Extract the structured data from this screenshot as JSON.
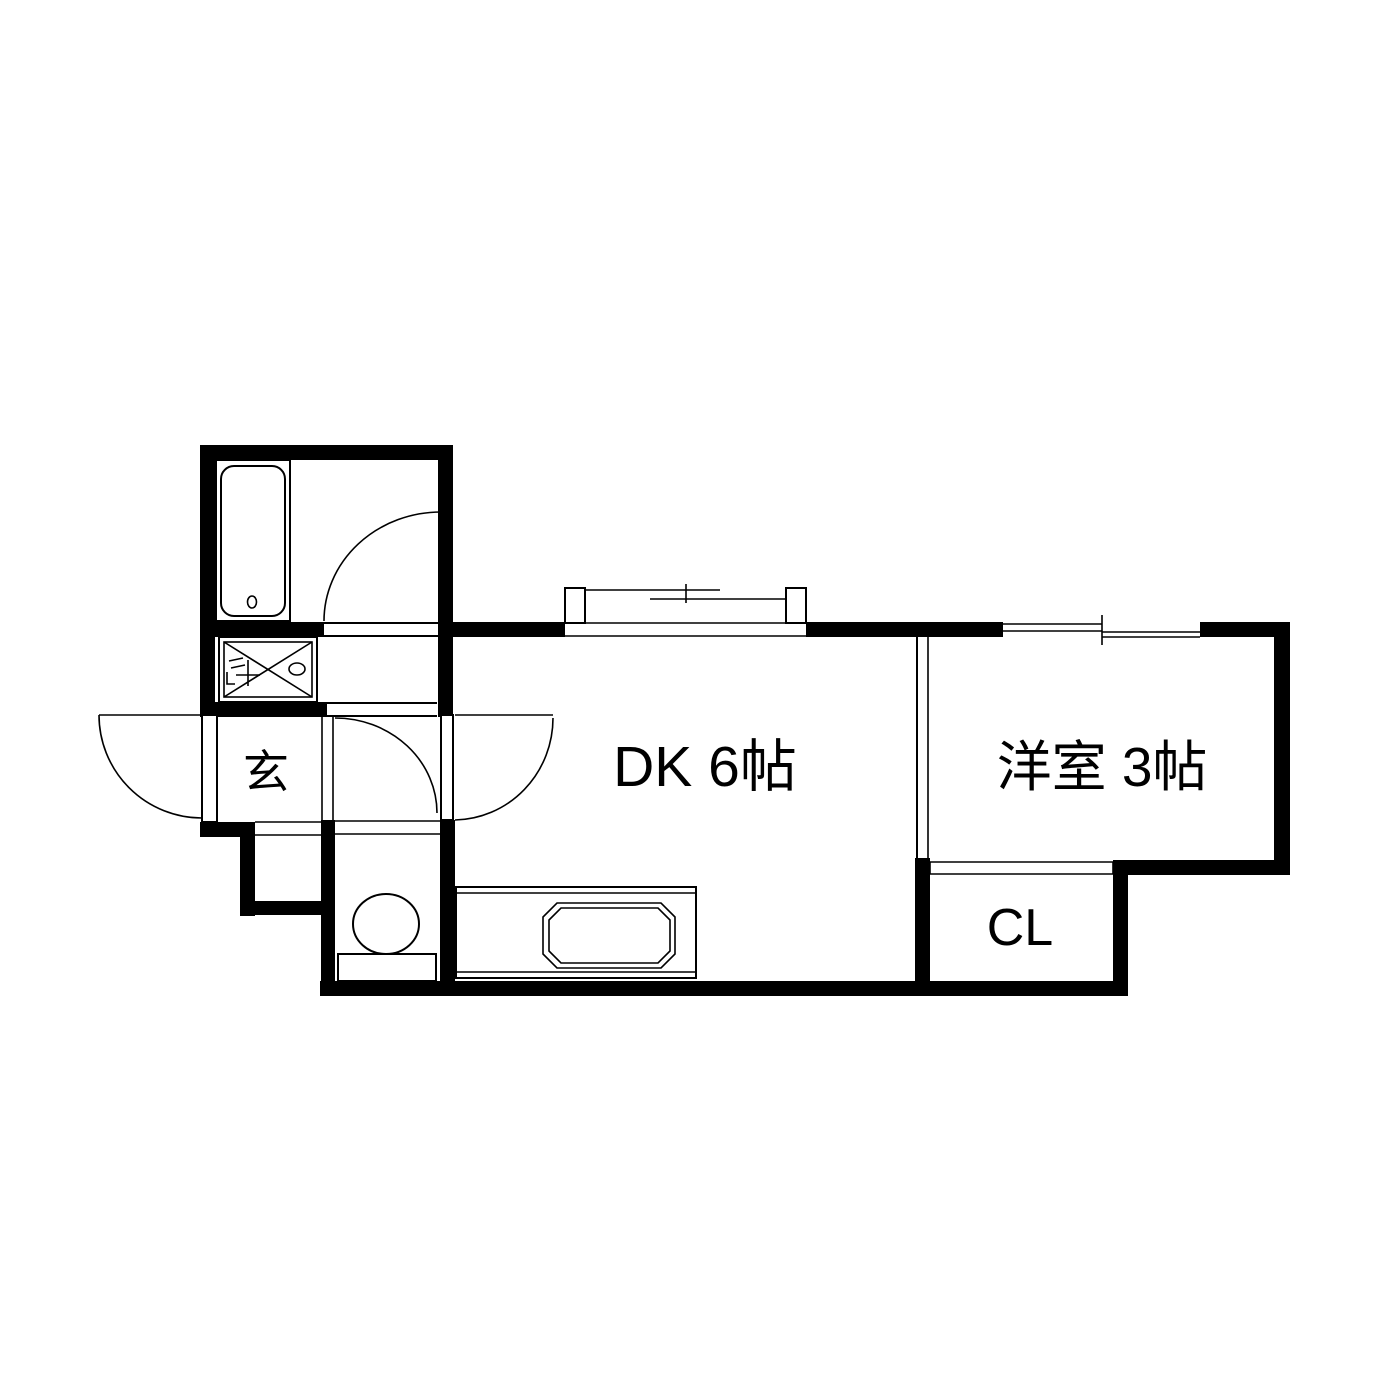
{
  "floor_plan": {
    "background": "#ffffff",
    "wall_color": "#000000",
    "line_color": "#000000",
    "text_color": "#000000",
    "rooms": {
      "entrance": {
        "label": "玄"
      },
      "dining_kitchen": {
        "label": "DK 6帖"
      },
      "western_room": {
        "label": "洋室 3帖"
      },
      "closet": {
        "label": "CL"
      }
    },
    "fixtures": [
      "bathtub-icon",
      "washing-machine-pan-icon",
      "faucet-icon",
      "toilet-icon",
      "kitchen-counter-icon",
      "kitchen-sink-icon",
      "bay-window-icon",
      "sliding-window-icon",
      "swing-door-icon",
      "sliding-door-icon"
    ]
  }
}
